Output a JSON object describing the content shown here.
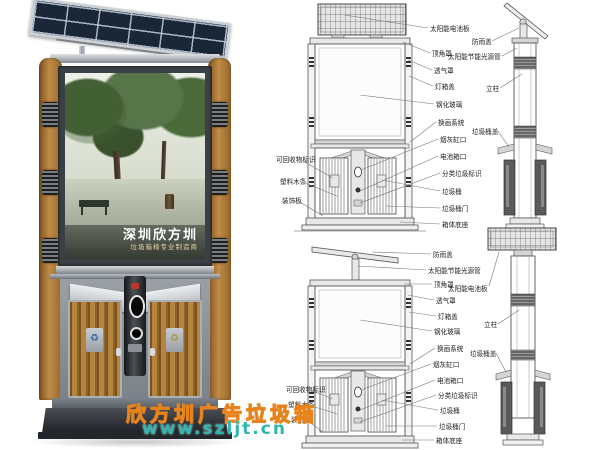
{
  "poster": {
    "title": "深圳欣方圳",
    "subtitle": "垃圾箱椅专业制造商"
  },
  "watermark": {
    "brand_text": "欣方圳广告垃圾箱",
    "url": "www.szljt.cn"
  },
  "icons": {
    "recycle": "♻"
  },
  "labels": {
    "solar_panel": "太阳能电池板",
    "rain_cover": "防雨盖",
    "solar_lamp_tube": "太阳能节能光源管",
    "corner_cover": "顶角罩",
    "vent_cover": "透气罩",
    "box_cover": "灯箱盖",
    "tempered_glass": "钢化玻璃",
    "change_system": "换画系统",
    "ashtray_port": "烟灰缸口",
    "battery_port": "电池箱口",
    "sorting_sign": "分类垃圾标识",
    "trash_bin": "垃圾桶",
    "bin_door": "垃圾桶门",
    "box_base": "箱体底座",
    "recyclable_sign": "可回收物标识",
    "plastic_wood": "塑料木条",
    "decor_panel": "装饰板",
    "pillar": "立柱",
    "bin_cover": "垃圾桶盖"
  },
  "colors": {
    "wood": "#b5843f",
    "solar_cell": "#1b2737",
    "metal": "#aab0b5",
    "watermark_orange": "#e8831c",
    "watermark_teal": "#2eb6b2"
  }
}
